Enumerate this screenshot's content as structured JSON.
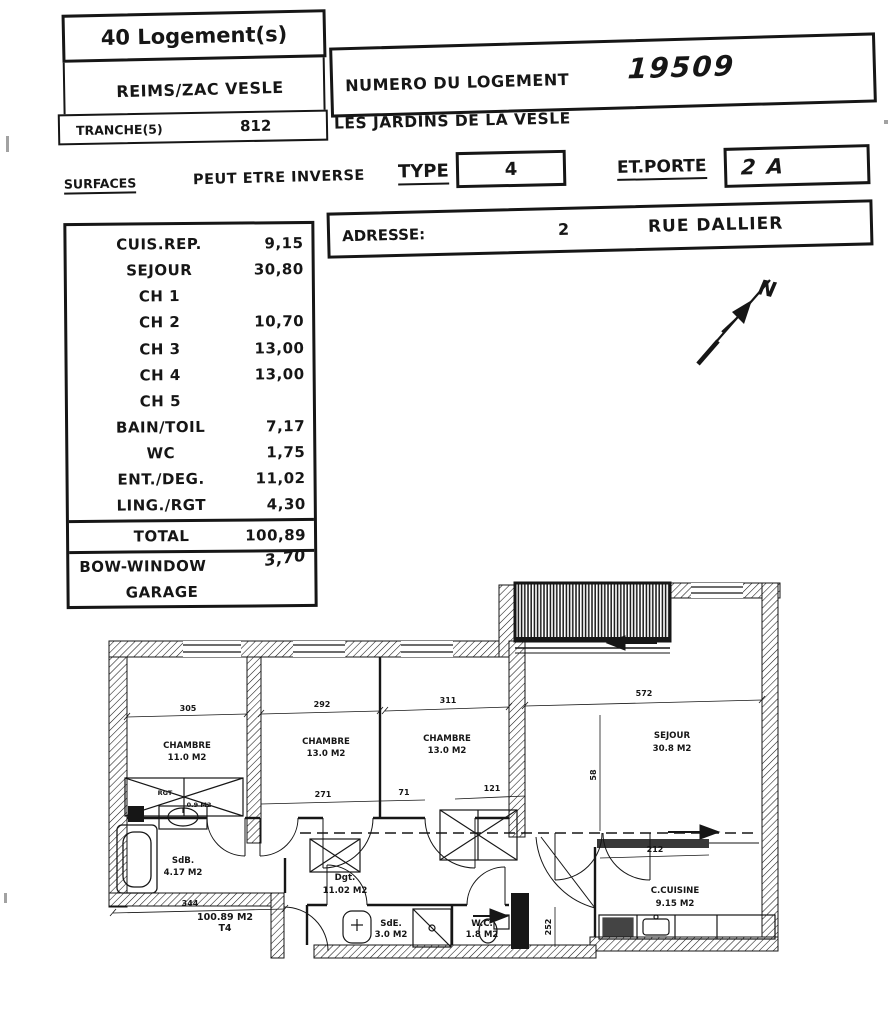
{
  "header": {
    "units_count": "40 Logement(s)",
    "project": "REIMS/ZAC VESLE",
    "tranche_label": "TRANCHE(5)",
    "tranche_value": "812",
    "unit_number_label": "NUMERO DU LOGEMENT",
    "unit_number_value": "19509",
    "residence_name": "LES JARDINS DE LA VESLE"
  },
  "type_row": {
    "surfaces_label": "SURFACES",
    "note": "PEUT ETRE INVERSE",
    "type_label": "TYPE",
    "type_value": "4",
    "door_label": "ET.PORTE",
    "door_value": "2 A"
  },
  "address": {
    "label": "ADRESSE:",
    "number": "2",
    "street": "RUE DALLIER"
  },
  "surfaces_table": {
    "rows": [
      {
        "label": "CUIS.REP.",
        "value": "9,15"
      },
      {
        "label": "SEJOUR",
        "value": "30,80"
      },
      {
        "label": "CH 1",
        "value": ""
      },
      {
        "label": "CH 2",
        "value": "10,70"
      },
      {
        "label": "CH 3",
        "value": "13,00"
      },
      {
        "label": "CH 4",
        "value": "13,00"
      },
      {
        "label": "CH 5",
        "value": ""
      },
      {
        "label": "BAIN/TOIL",
        "value": "7,17"
      },
      {
        "label": "WC",
        "value": "1,75"
      },
      {
        "label": "ENT./DEG.",
        "value": "11,02"
      },
      {
        "label": "LING./RGT",
        "value": "4,30"
      }
    ],
    "total_label": "TOTAL",
    "total_value": "100,89",
    "bow_window_label": "BOW-WINDOW",
    "bow_window_value": "3,70",
    "garage_label": "GARAGE"
  },
  "plan": {
    "north_label": "N",
    "rooms": [
      {
        "name": "CHAMBRE",
        "area": "11.0 M2"
      },
      {
        "name": "CHAMBRE",
        "area": "13.0 M2"
      },
      {
        "name": "CHAMBRE",
        "area": "13.0 M2"
      },
      {
        "name": "SEJOUR",
        "area": "30.8 M2"
      },
      {
        "name": "SdB.",
        "area": "4.17 M2"
      },
      {
        "name": "Dgt.",
        "area": "11.02 M2"
      },
      {
        "name": "SdE.",
        "area": "3.0 M2"
      },
      {
        "name": "W.C.",
        "area": "1.8 M2"
      },
      {
        "name": "C.CUISINE",
        "area": "9.15 M2"
      },
      {
        "name": "RGT",
        "area": "0.9 M2"
      }
    ],
    "summary": {
      "total_area": "100.89 M2",
      "type_code": "T4"
    },
    "dims": {
      "ch1": "305",
      "ch2": "292",
      "ch3": "311",
      "sejour": "572",
      "hall": "271",
      "hall2": "71",
      "hall3": "121",
      "kitchen": "212",
      "bottom": "344",
      "v_sejour": "58",
      "v_kitchen": "252"
    }
  }
}
